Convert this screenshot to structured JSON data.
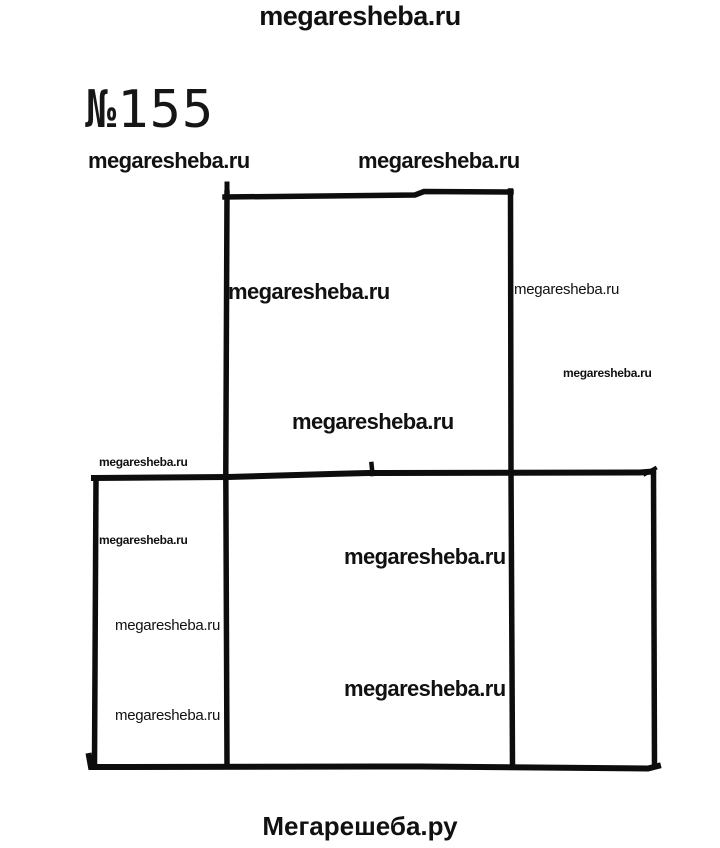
{
  "colors": {
    "ink": "#0d0d0d",
    "background": "#ffffff"
  },
  "header": {
    "top_watermark": "megaresheba.ru",
    "problem_number": "№155"
  },
  "watermarks": {
    "row_left": "megaresheba.ru",
    "row_right": "megaresheba.ru",
    "square_top_left": "megaresheba.ru",
    "square_right_outside": "megaresheba.ru",
    "right_margin_small": "megaresheba.ru",
    "square_center": "megaresheba.ru",
    "above_divider_left": "megaresheba.ru",
    "left_cell_top": "megaresheba.ru",
    "left_cell_middle": "megaresheba.ru",
    "left_cell_bottom": "megaresheba.ru",
    "middle_cell_top": "megaresheba.ru",
    "middle_cell_bottom": "megaresheba.ru"
  },
  "footer": {
    "site_name": "Мегарешеба.ру"
  }
}
